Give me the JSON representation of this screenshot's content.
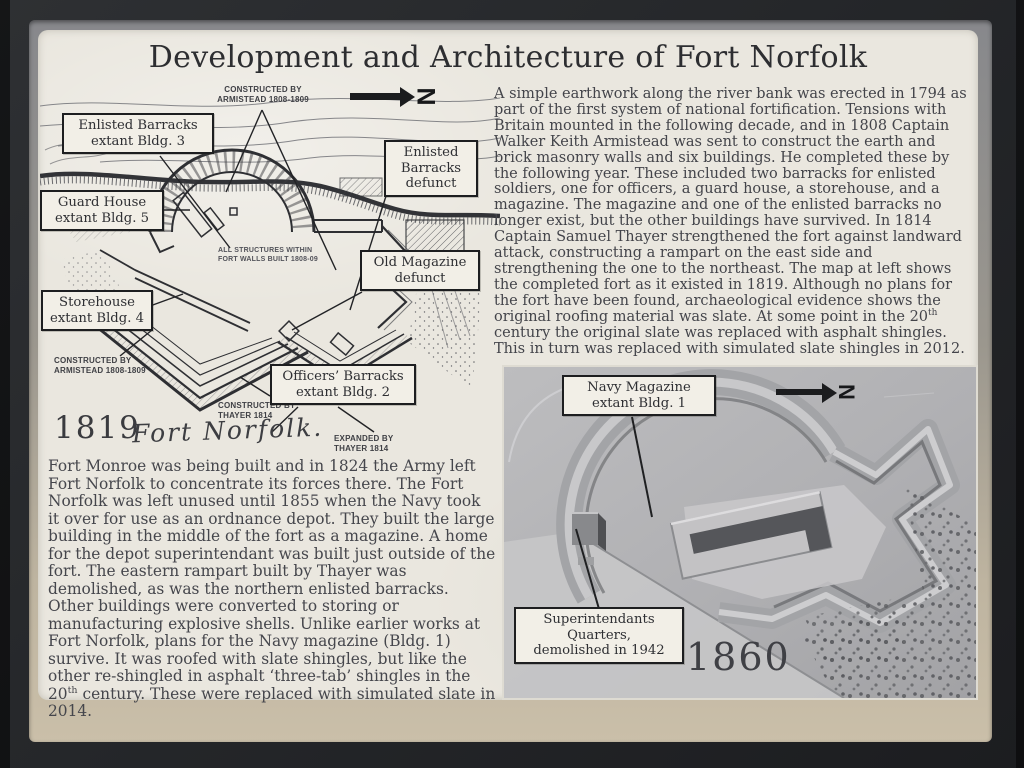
{
  "colors": {
    "plaque_bg": "#eae7df",
    "ink": "#3a3b3f",
    "frame": "#26282b",
    "mat_top": "#87888c",
    "mat_bottom": "#cabfa9",
    "photo_gray": "#b3b3b5"
  },
  "title": "Development and Architecture of Fort Norfolk",
  "map_1819": {
    "year": "1819",
    "script_title": "Fort Norfolk.",
    "north_letter": "N",
    "callouts": {
      "enlisted_extant": "Enlisted Barracks\nextant Bldg. 3",
      "enlisted_defunct": "Enlisted\nBarracks\ndefunct",
      "guard_house": "Guard House\nextant Bldg. 5",
      "old_magazine": "Old Magazine\ndefunct",
      "storehouse": "Storehouse\nextant Bldg. 4",
      "officers_barracks": "Officers’ Barracks\nextant Bldg. 2"
    },
    "annotations": {
      "constructed_armistead_top": "CONSTRUCTED BY\nARMISTEAD 1808-1809",
      "all_structures": "ALL STRUCTURES WITHIN\nFORT WALLS BUILT 1808-09",
      "constructed_armistead_bottom": "CONSTRUCTED BY\nARMISTEAD 1808-1809",
      "constructed_thayer": "CONSTRUCTED BY\nTHAYER 1814",
      "expanded_thayer": "EXPANDED BY\nTHAYER 1814"
    }
  },
  "paragraphs": {
    "right": {
      "pre": "A simple earthwork along the river bank was erected in 1794 as part of the first system of national fortification.  Tensions with Britain mounted in the following decade, and in 1808 Captain Walker Keith Armistead was sent to construct the earth and brick masonry walls and six buildings.  He completed these by the following year.  These included two barracks for enlisted soldiers, one for officers, a guard house, a storehouse, and a magazine.  The magazine and one of the enlisted barracks no longer exist, but the other buildings have survived.  In 1814 Captain Samuel Thayer strengthened the fort against landward attack, constructing a rampart on the east side and strengthening the one to the northeast. The map at left shows the completed fort as it existed in 1819. Although no plans for the fort have been found, archaeological evidence shows the original roofing material was slate.  At some point in the 20",
      "sup": "th",
      "post": " century the original slate was replaced with asphalt shingles.  This in turn was replaced with simulated slate shingles in 2012."
    },
    "left": {
      "pre": "Fort Monroe was being built and in 1824 the Army left Fort Norfolk to concentrate its forces there.  The Fort Norfolk was left unused until 1855 when the Navy took it over for use as an ordnance depot. They built the large building in the middle of the fort as a magazine.  A home for the depot superintendant was built just outside of the fort. The eastern rampart built by Thayer was demolished, as was the northern enlisted barracks.  Other buildings were converted to storing or manufacturing explosive shells.  Unlike earlier works at Fort Norfolk, plans for the Navy magazine (Bldg. 1) survive.  It was roofed with slate shingles, but like the other re-shingled in asphalt ‘three-tab’ shingles in the 20",
      "sup": "th",
      "post": " century.  These were replaced with simulated slate in 2014."
    }
  },
  "photo_1860": {
    "year": "1860",
    "north_letter": "N",
    "callouts": {
      "navy_magazine": "Navy Magazine\nextant Bldg. 1",
      "superintendants": "Superintendants\nQuarters,\ndemolished in 1942"
    }
  }
}
